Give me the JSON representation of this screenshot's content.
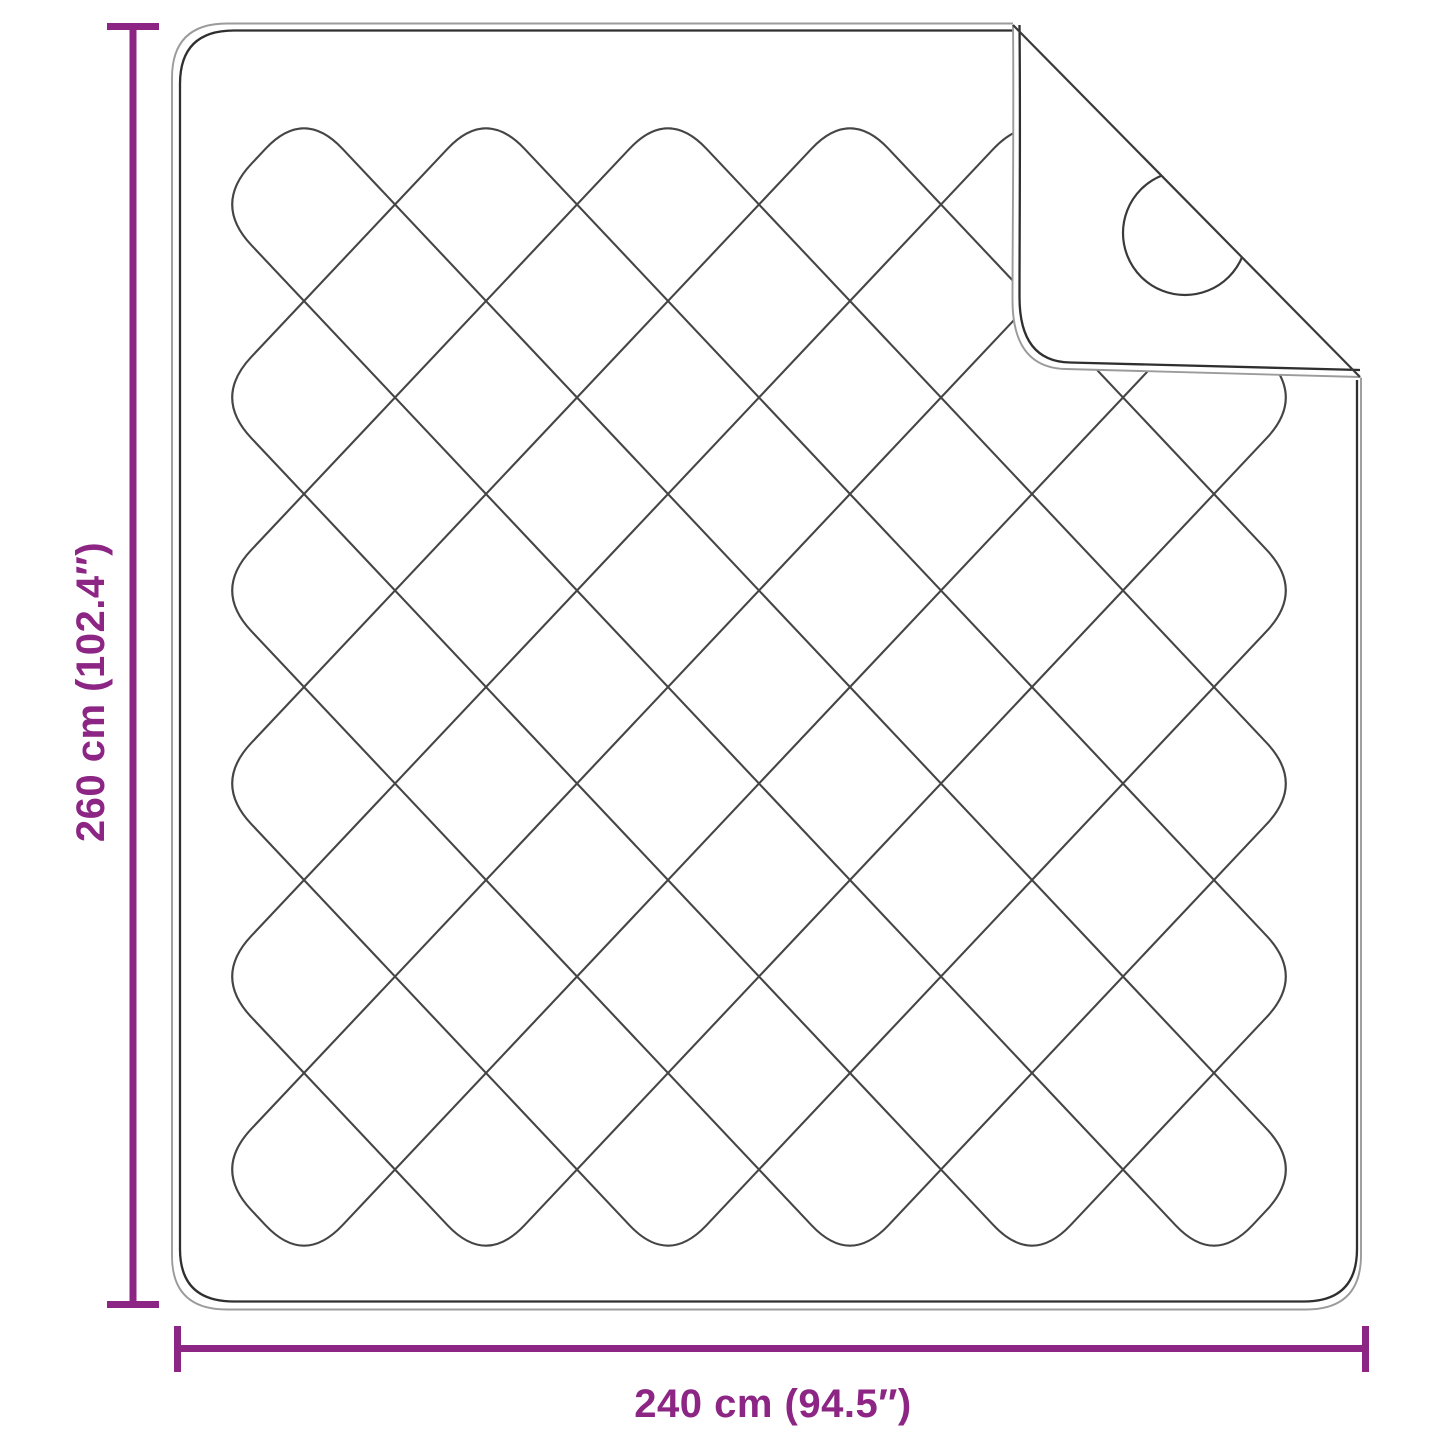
{
  "diagram": {
    "type": "product-dimension-diagram",
    "subject": "quilted blanket with folded corner",
    "height_label": "260 cm (102.4″)",
    "width_label": "240 cm (94.5″)"
  },
  "colors": {
    "dimension_accent": "#8C2583",
    "outline_dark": "#2f2f2f",
    "outline_light": "#9b9b9b",
    "stitch_line": "#454545",
    "background": "#ffffff"
  }
}
